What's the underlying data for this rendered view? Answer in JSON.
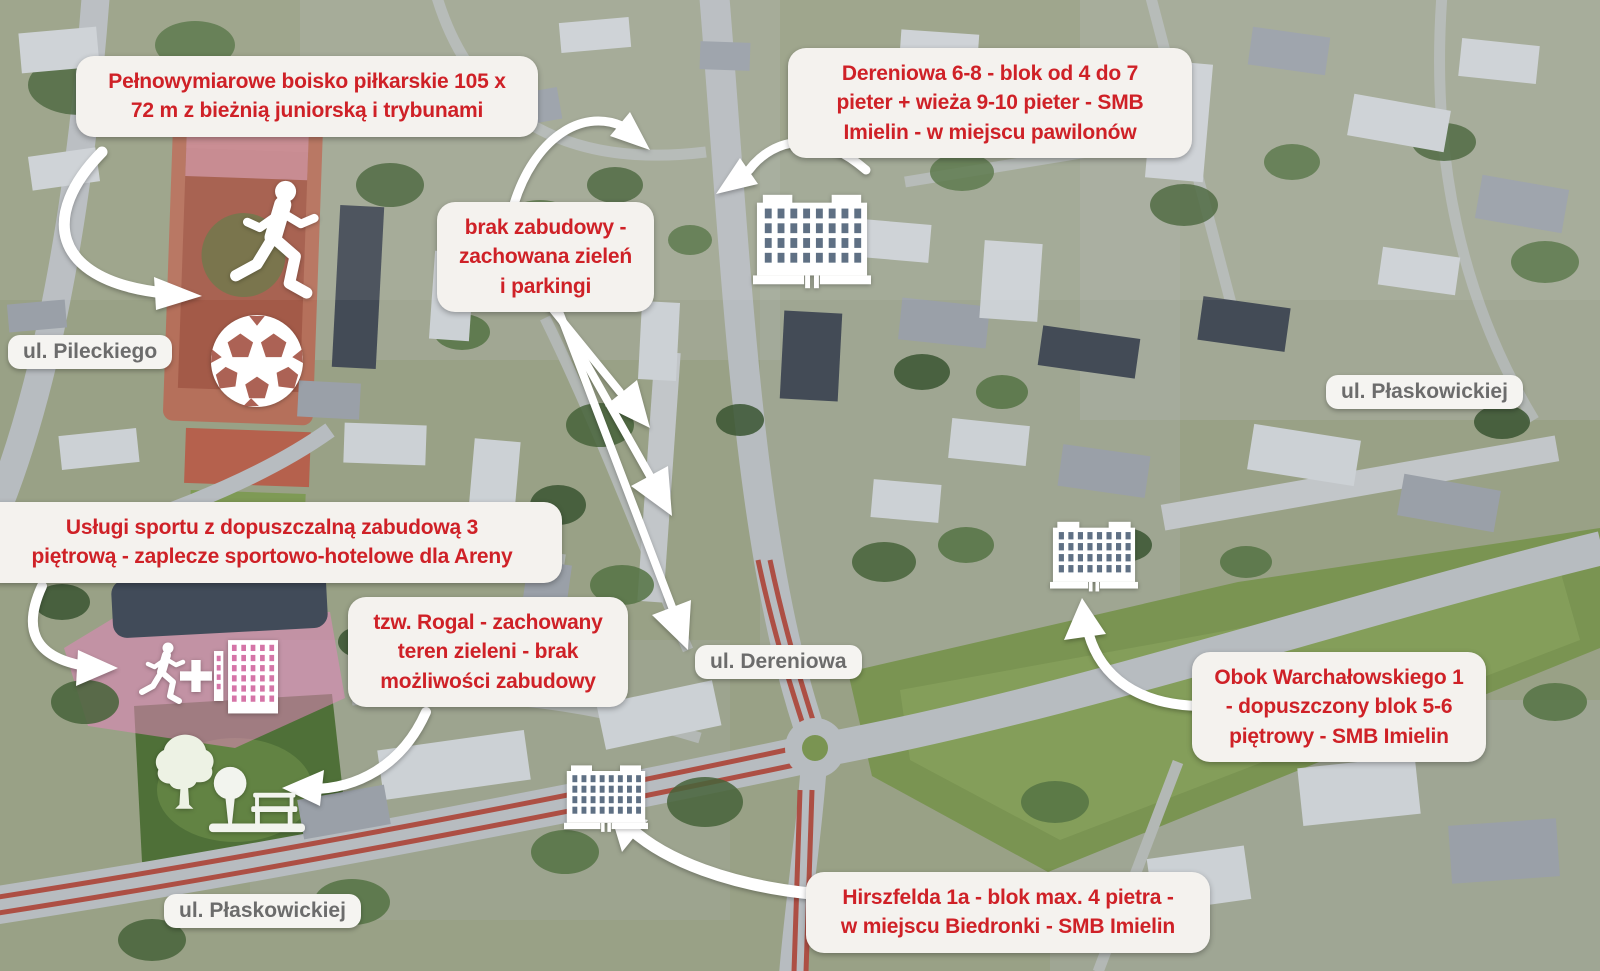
{
  "annotations": [
    {
      "id": "boisko",
      "text": "Pełnowymiarowe boisko piłkarskie 105 x\n72 m z bieżnią juniorską i trybunami"
    },
    {
      "id": "dereniowa-6-8",
      "text": "Dereniowa 6-8 - blok od 4 do 7\npieter + wieża 9-10 pieter - SMB\nImielin - w miejscu pawilonów"
    },
    {
      "id": "brak-zabudowy",
      "text": "brak zabudowy -\nzachowana zieleń\ni parkingi"
    },
    {
      "id": "uslugi-sportu",
      "text": "Usługi sportu z dopuszczalną zabudową 3\npiętrową - zaplecze sportowo-hotelowe dla Areny"
    },
    {
      "id": "rogal",
      "text": "tzw. Rogal - zachowany\nteren zieleni - brak\nmożliwości zabudowy"
    },
    {
      "id": "warchalowskiego",
      "text": "Obok Warchałowskiego 1\n- dopuszczony blok 5-6\npiętrowy - SMB Imielin"
    },
    {
      "id": "hirszfelda",
      "text": "Hirszfelda 1a - blok max. 4 pietra -\nw miejscu Biedronki - SMB Imielin"
    }
  ],
  "street_labels": [
    {
      "id": "pileckiego",
      "text": "ul. Pileckiego"
    },
    {
      "id": "plaskowickiej-east",
      "text": "ul. Płaskowickiej"
    },
    {
      "id": "dereniowa",
      "text": "ul. Dereniowa"
    },
    {
      "id": "plaskowickiej-south",
      "text": "ul. Płaskowickiej"
    }
  ],
  "icons": [
    "runner-icon",
    "soccer-ball-icon",
    "apartment-building-icon",
    "apartment-building-icon",
    "apartment-building-icon",
    "runner-icon",
    "plus-icon",
    "sports-building-icon",
    "tree-icon",
    "small-tree-and-bench-icon"
  ],
  "colors": {
    "annotation_text": "#cf2127",
    "annotation_bg": "#f4f2ee",
    "street_text": "#6c6c6c",
    "icon_white": "#ffffff"
  }
}
